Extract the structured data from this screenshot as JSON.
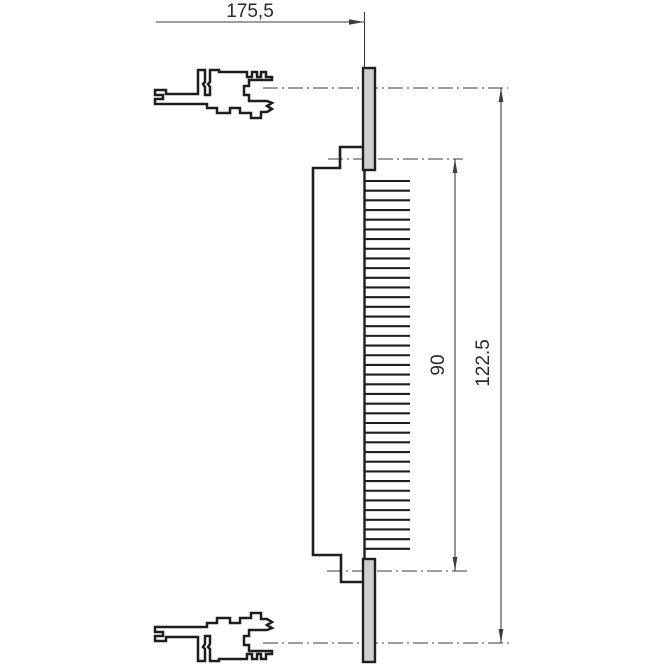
{
  "dimensions": {
    "width": {
      "label": "175,5"
    },
    "pin_field_height": {
      "label": "90"
    },
    "panel_height": {
      "label": "122.5"
    }
  },
  "pins": {
    "count": 39
  },
  "colors": {
    "line": "#1e1e1e",
    "dim": "#3d3d3d",
    "plate_fill": "#cfcfcf",
    "bg": "#ffffff"
  }
}
